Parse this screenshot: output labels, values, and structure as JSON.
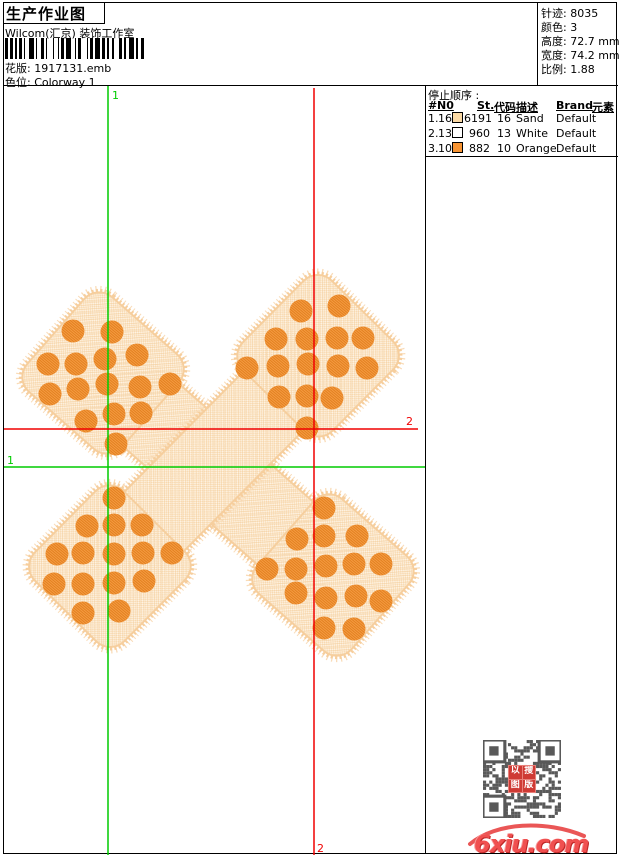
{
  "header": {
    "title": "生产作业图",
    "studio": "Wilcom(汇京) 装饰工作室",
    "pattern_label": "花版:",
    "pattern_value": "1917131.emb",
    "colorway_label": "色位:",
    "colorway_value": "Colorway 1"
  },
  "stats": {
    "stitches_label": "针迹:",
    "stitches_value": "8035",
    "colors_label": "颜色:",
    "colors_value": "3",
    "height_label": "高度:",
    "height_value": "72.7 mm",
    "width_label": "宽度:",
    "width_value": "74.2 mm",
    "scale_label": "比例:",
    "scale_value": "1.88"
  },
  "color_sequence": {
    "title": "停止顺序 :",
    "columns": [
      "#",
      "N0",
      "St.",
      "代码",
      "描述",
      "Brand",
      "元素"
    ],
    "rows": [
      {
        "seq": "1.",
        "needle": "16",
        "swatch": "#FBD9A4",
        "stitches": "6191",
        "code": "16",
        "description": "Sand",
        "brand": "Default",
        "elements": ""
      },
      {
        "seq": "2.",
        "needle": "13",
        "swatch": "#FFFFFF",
        "stitches": "960",
        "code": "13",
        "description": "White",
        "brand": "Default",
        "elements": ""
      },
      {
        "seq": "3.",
        "needle": "10",
        "swatch": "#F79433",
        "stitches": "882",
        "code": "10",
        "description": "Orange",
        "brand": "Default",
        "elements": ""
      }
    ]
  },
  "guides": {
    "green": {
      "label": "1",
      "color": "#00CC00",
      "v_x": 104,
      "h_y": 381
    },
    "red": {
      "label": "2",
      "color": "#F00000",
      "v_x": 310,
      "h_y": 343
    }
  },
  "palette": {
    "sand_fill_base": "#FEF3E3",
    "sand_fill_check": "#F8D9B0",
    "sand_edge": "#F6CE9D",
    "sand_fuzz": "#F8D7AF",
    "hatch": "#F3D2A6",
    "orange": "#F59B42",
    "orange_dark": "#E2801F",
    "qr_gray": "#595959",
    "seal_red": "#CF3A34",
    "logo_red": "#F05050"
  },
  "design": {
    "bandaids": [
      {
        "cx": 214,
        "cy": 388,
        "angle": 41.3,
        "len": 306,
        "pad": 126,
        "strip_w": 84
      },
      {
        "cx": 210,
        "cy": 375,
        "angle": 134.7,
        "len": 296,
        "pad": 126,
        "strip_w": 84
      }
    ],
    "dot_r": 11.5,
    "dots": [
      [
        [
          69,
          245
        ],
        [
          108,
          246
        ],
        [
          44,
          278
        ],
        [
          72,
          278
        ],
        [
          101,
          273
        ],
        [
          133,
          269
        ],
        [
          166,
          298
        ],
        [
          136,
          301
        ],
        [
          103,
          298
        ],
        [
          74,
          303
        ],
        [
          46,
          308
        ],
        [
          82,
          335
        ],
        [
          110,
          328
        ],
        [
          137,
          327
        ],
        [
          112,
          358
        ]
      ],
      [
        [
          297,
          225
        ],
        [
          335,
          220
        ],
        [
          272,
          253
        ],
        [
          303,
          253
        ],
        [
          333,
          252
        ],
        [
          359,
          252
        ],
        [
          243,
          282
        ],
        [
          274,
          280
        ],
        [
          304,
          278
        ],
        [
          334,
          280
        ],
        [
          363,
          282
        ],
        [
          275,
          311
        ],
        [
          303,
          310
        ],
        [
          328,
          312
        ],
        [
          303,
          342
        ]
      ],
      [
        [
          110,
          412
        ],
        [
          83,
          440
        ],
        [
          110,
          439
        ],
        [
          138,
          439
        ],
        [
          53,
          468
        ],
        [
          79,
          467
        ],
        [
          110,
          468
        ],
        [
          139,
          467
        ],
        [
          168,
          467
        ],
        [
          50,
          498
        ],
        [
          79,
          498
        ],
        [
          110,
          497
        ],
        [
          140,
          495
        ],
        [
          79,
          527
        ],
        [
          115,
          525
        ]
      ],
      [
        [
          320,
          422
        ],
        [
          293,
          453
        ],
        [
          320,
          450
        ],
        [
          353,
          450
        ],
        [
          263,
          483
        ],
        [
          292,
          483
        ],
        [
          322,
          480
        ],
        [
          350,
          478
        ],
        [
          377,
          478
        ],
        [
          292,
          507
        ],
        [
          322,
          512
        ],
        [
          352,
          510
        ],
        [
          377,
          515
        ],
        [
          320,
          542
        ],
        [
          350,
          543
        ]
      ]
    ]
  },
  "barcode": {
    "pattern": "2121112112311221131211213211231121312112132112311221"
  },
  "footer": {
    "watermark": "6xiu.com",
    "seal_chars": [
      "以",
      "搜",
      "图",
      "版"
    ]
  }
}
